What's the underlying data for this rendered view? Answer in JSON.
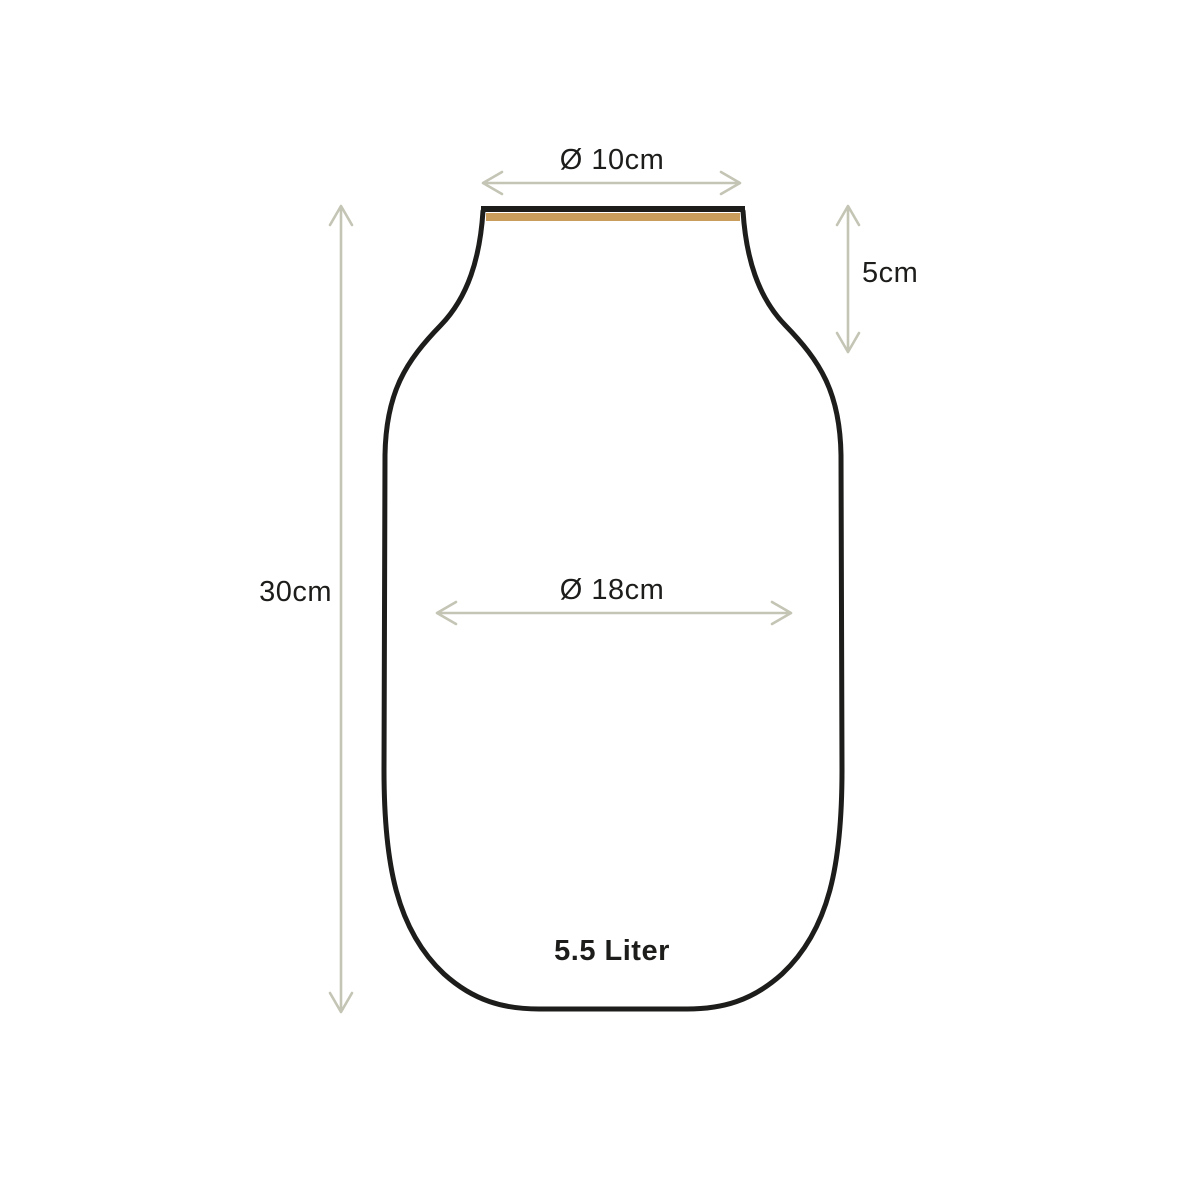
{
  "diagram": {
    "title": "vase-dimension-diagram",
    "labels": {
      "top_diameter": "Ø 10cm",
      "neck_height": "5cm",
      "total_height": "30cm",
      "body_diameter": "Ø 18cm",
      "volume": "5.5 Liter"
    },
    "dimensions": {
      "top_diameter_cm": 10,
      "neck_height_cm": 5,
      "total_height_cm": 30,
      "body_diameter_cm": 18,
      "volume_liter": 5.5
    },
    "colors": {
      "background": "#ffffff",
      "outline": "#1d1d1b",
      "rim_accent": "#c99e5d",
      "dimension_lines": "#c4c5b5",
      "text": "#1d1d1b"
    }
  }
}
